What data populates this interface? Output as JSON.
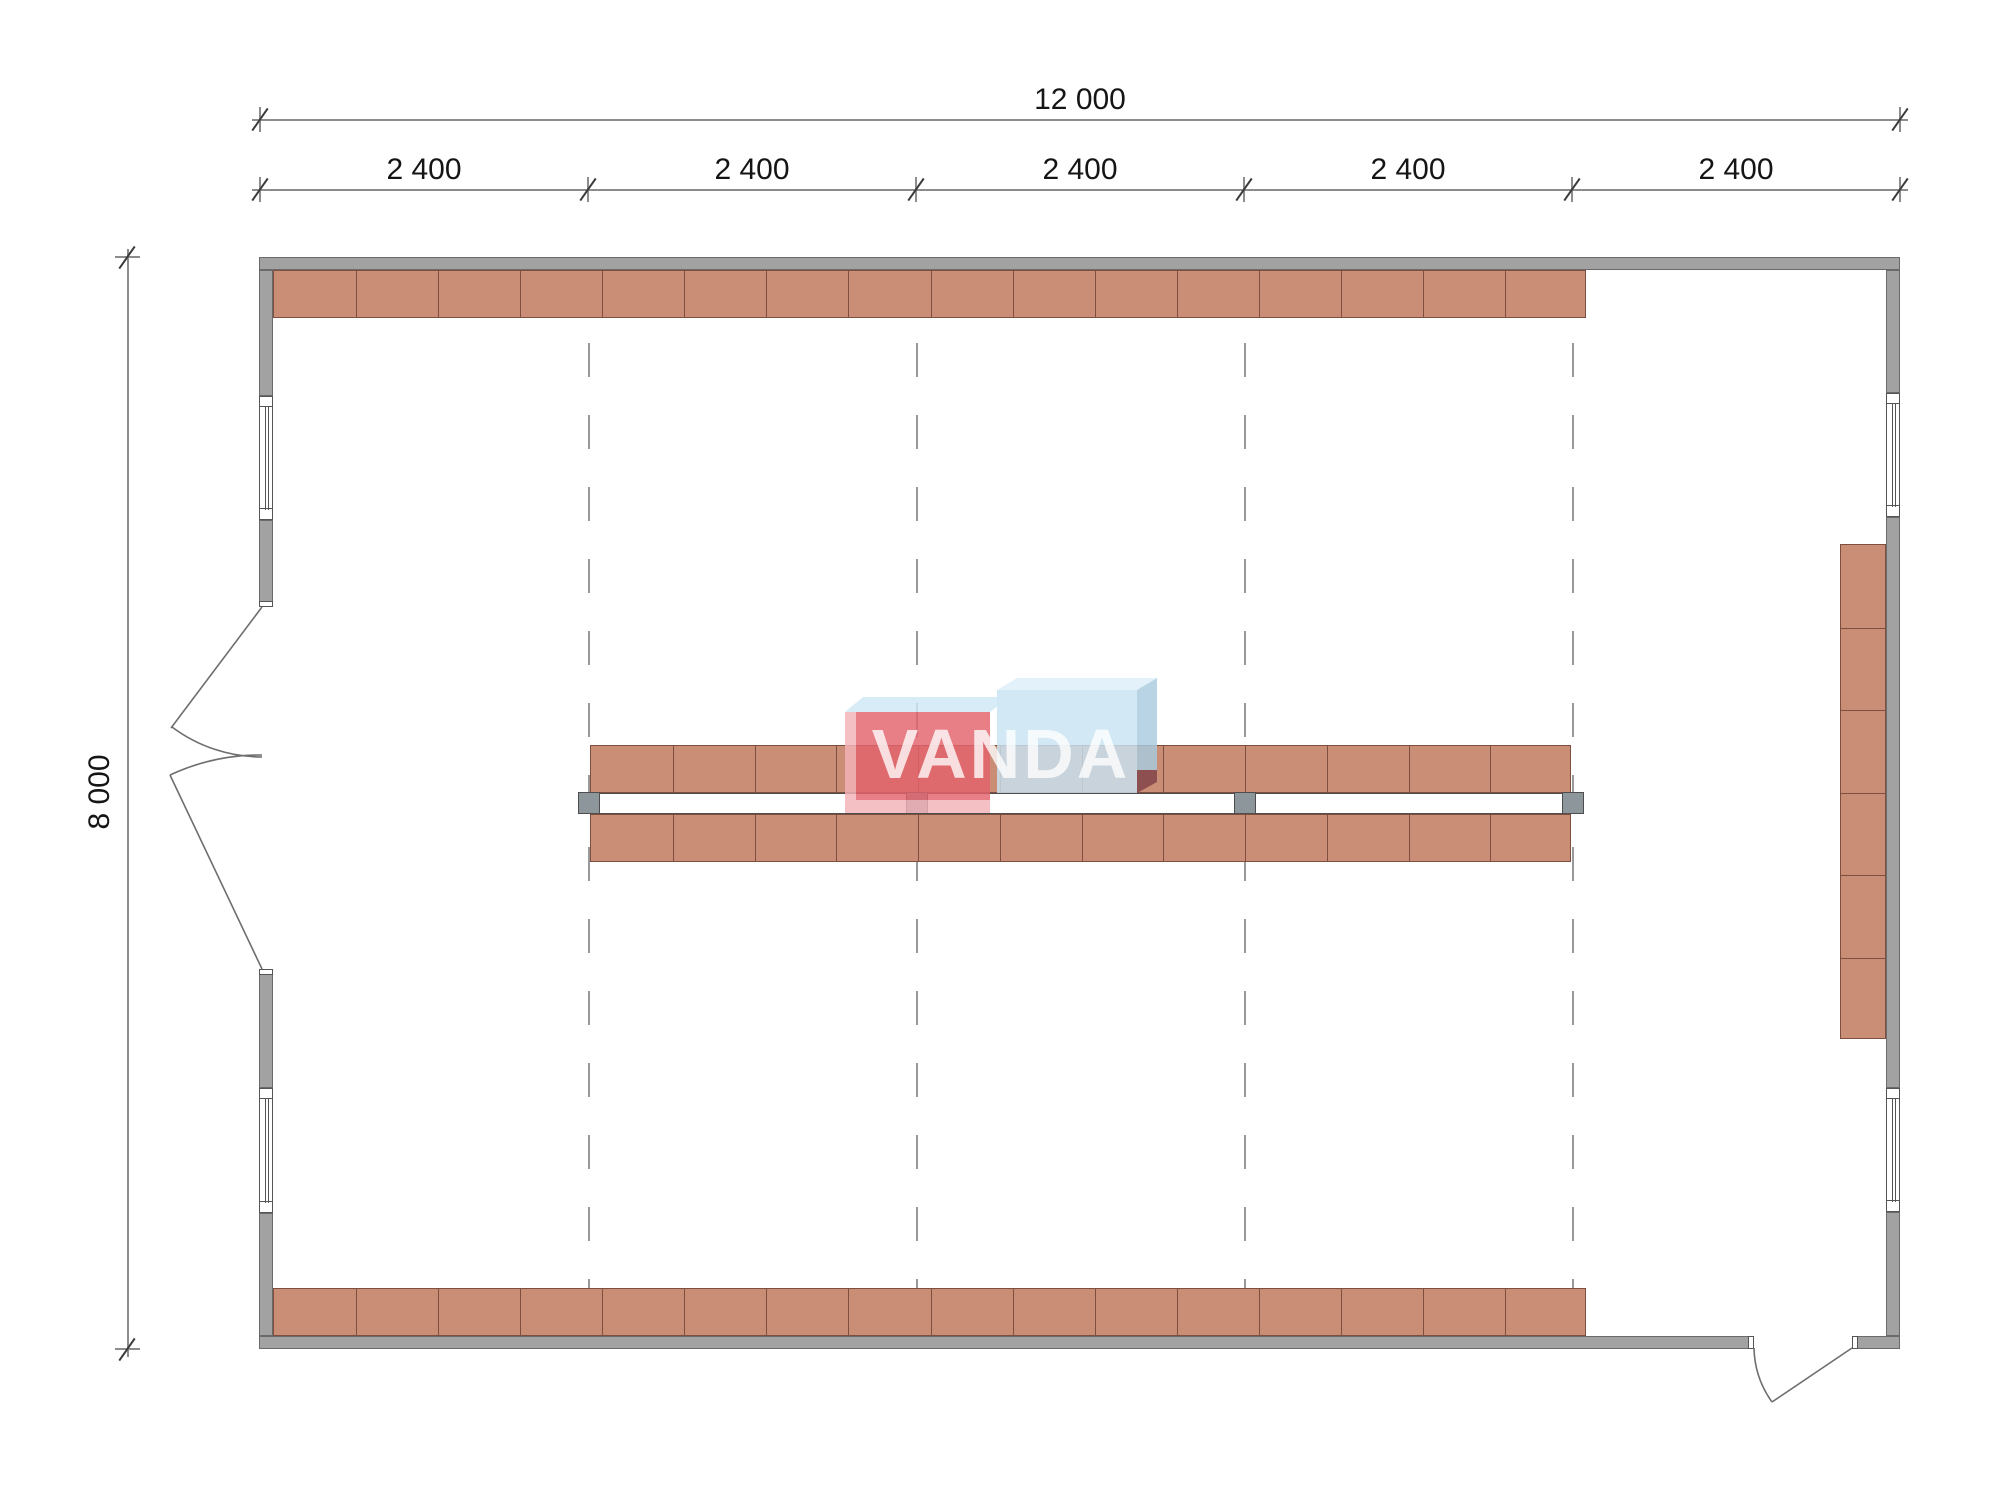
{
  "watermark": {
    "text": "VANDA"
  },
  "dimensions": {
    "total_label": "12 000",
    "height_label": "8 000",
    "bays": [
      {
        "label": "2 400"
      },
      {
        "label": "2 400"
      },
      {
        "label": "2 400"
      },
      {
        "label": "2 400"
      },
      {
        "label": "2 400"
      }
    ]
  },
  "colors": {
    "wall": "#a2a2a2",
    "wall-border": "#6a6a6a",
    "shelf": "#c98e75",
    "shelf-border": "#7e4f3e",
    "post": "#8d969b",
    "post-border": "#4d4d4d",
    "beam-border": "#4d4d4d",
    "grid": "#999999",
    "frame": "#555555",
    "dim": "#8c8c8c",
    "tick": "#3a3a3a",
    "door": "#6e6e6e",
    "wm-pink-light": "#f4b3b8",
    "wm-red": "#e4636d",
    "wm-blue": "#c9e3f2",
    "wm-blue-top": "#ddeffa",
    "wm-blue-dark": "#a9cbe0",
    "wm-maroon": "#82424a",
    "wm-pink-top": "#cfe9f5"
  },
  "plan": {
    "walls": [
      [
        259,
        257,
        1641,
        13
      ],
      [
        259,
        1336,
        1490,
        13
      ],
      [
        1857,
        1336,
        43,
        13
      ],
      [
        259,
        270,
        14,
        126
      ],
      [
        259,
        520,
        14,
        82
      ],
      [
        259,
        974,
        14,
        114
      ],
      [
        259,
        1213,
        14,
        123
      ],
      [
        1886,
        270,
        14,
        123
      ],
      [
        1886,
        517,
        14,
        571
      ],
      [
        1886,
        1212,
        14,
        124
      ]
    ],
    "grid_x": [
      588,
      916,
      1244,
      1572
    ],
    "grid_top": 271,
    "grid_height": 1065,
    "shelf_rows": [
      {
        "name": "top-shelf-row",
        "x": 273,
        "y": 270,
        "w": 1313,
        "h": 48,
        "segments": 16,
        "dir": "h"
      },
      {
        "name": "bottom-shelf-row",
        "x": 273,
        "y": 1288,
        "w": 1313,
        "h": 48,
        "segments": 16,
        "dir": "h"
      },
      {
        "name": "mid-upper-shelf-row",
        "x": 590,
        "y": 745,
        "w": 981,
        "h": 48,
        "segments": 12,
        "dir": "h"
      },
      {
        "name": "mid-lower-shelf-row",
        "x": 590,
        "y": 814,
        "w": 981,
        "h": 48,
        "segments": 12,
        "dir": "h"
      },
      {
        "name": "right-shelf-column",
        "x": 1840,
        "y": 544,
        "w": 46,
        "h": 495,
        "segments": 6,
        "dir": "v"
      }
    ],
    "beam": [
      578,
      793,
      1006,
      21
    ],
    "columns": [
      [
        578,
        792,
        22,
        22
      ],
      [
        906,
        792,
        22,
        22
      ],
      [
        1234,
        792,
        22,
        22
      ],
      [
        1562,
        792,
        22,
        22
      ]
    ],
    "windows": [
      [
        259,
        396,
        14,
        124
      ],
      [
        259,
        1088,
        14,
        125
      ],
      [
        1886,
        393,
        14,
        124
      ],
      [
        1886,
        1088,
        14,
        124
      ]
    ],
    "jambs": [
      [
        259,
        601,
        14,
        6
      ],
      [
        259,
        969,
        14,
        6
      ],
      [
        1748,
        1336,
        6,
        13
      ],
      [
        1852,
        1336,
        6,
        13
      ]
    ],
    "doors": {
      "left_leaf_top": "M 262 607 L 171 728",
      "left_arc_top": "M 262 757 A 150 150 0 0 1 172 727",
      "left_leaf_bottom": "M 262 969 L 170 775",
      "left_arc_bottom": "M 262 755 A 214 214 0 0 0 170 775",
      "right_leaf": "M 1852 1348 L 1772 1402",
      "right_arc": "M 1754 1348 A 96 96 0 0 0 1772 1402"
    },
    "dims": [
      {
        "o": "h",
        "y": 119,
        "a": 252,
        "b": 1908,
        "ticks": [
          260,
          1900
        ]
      },
      {
        "o": "h",
        "y": 189,
        "a": 252,
        "b": 1908,
        "ticks": [
          260,
          588,
          916,
          1244,
          1572,
          1900
        ]
      },
      {
        "o": "v",
        "x": 127,
        "a": 249,
        "b": 1357,
        "ticks": [
          257,
          1349
        ]
      }
    ]
  }
}
